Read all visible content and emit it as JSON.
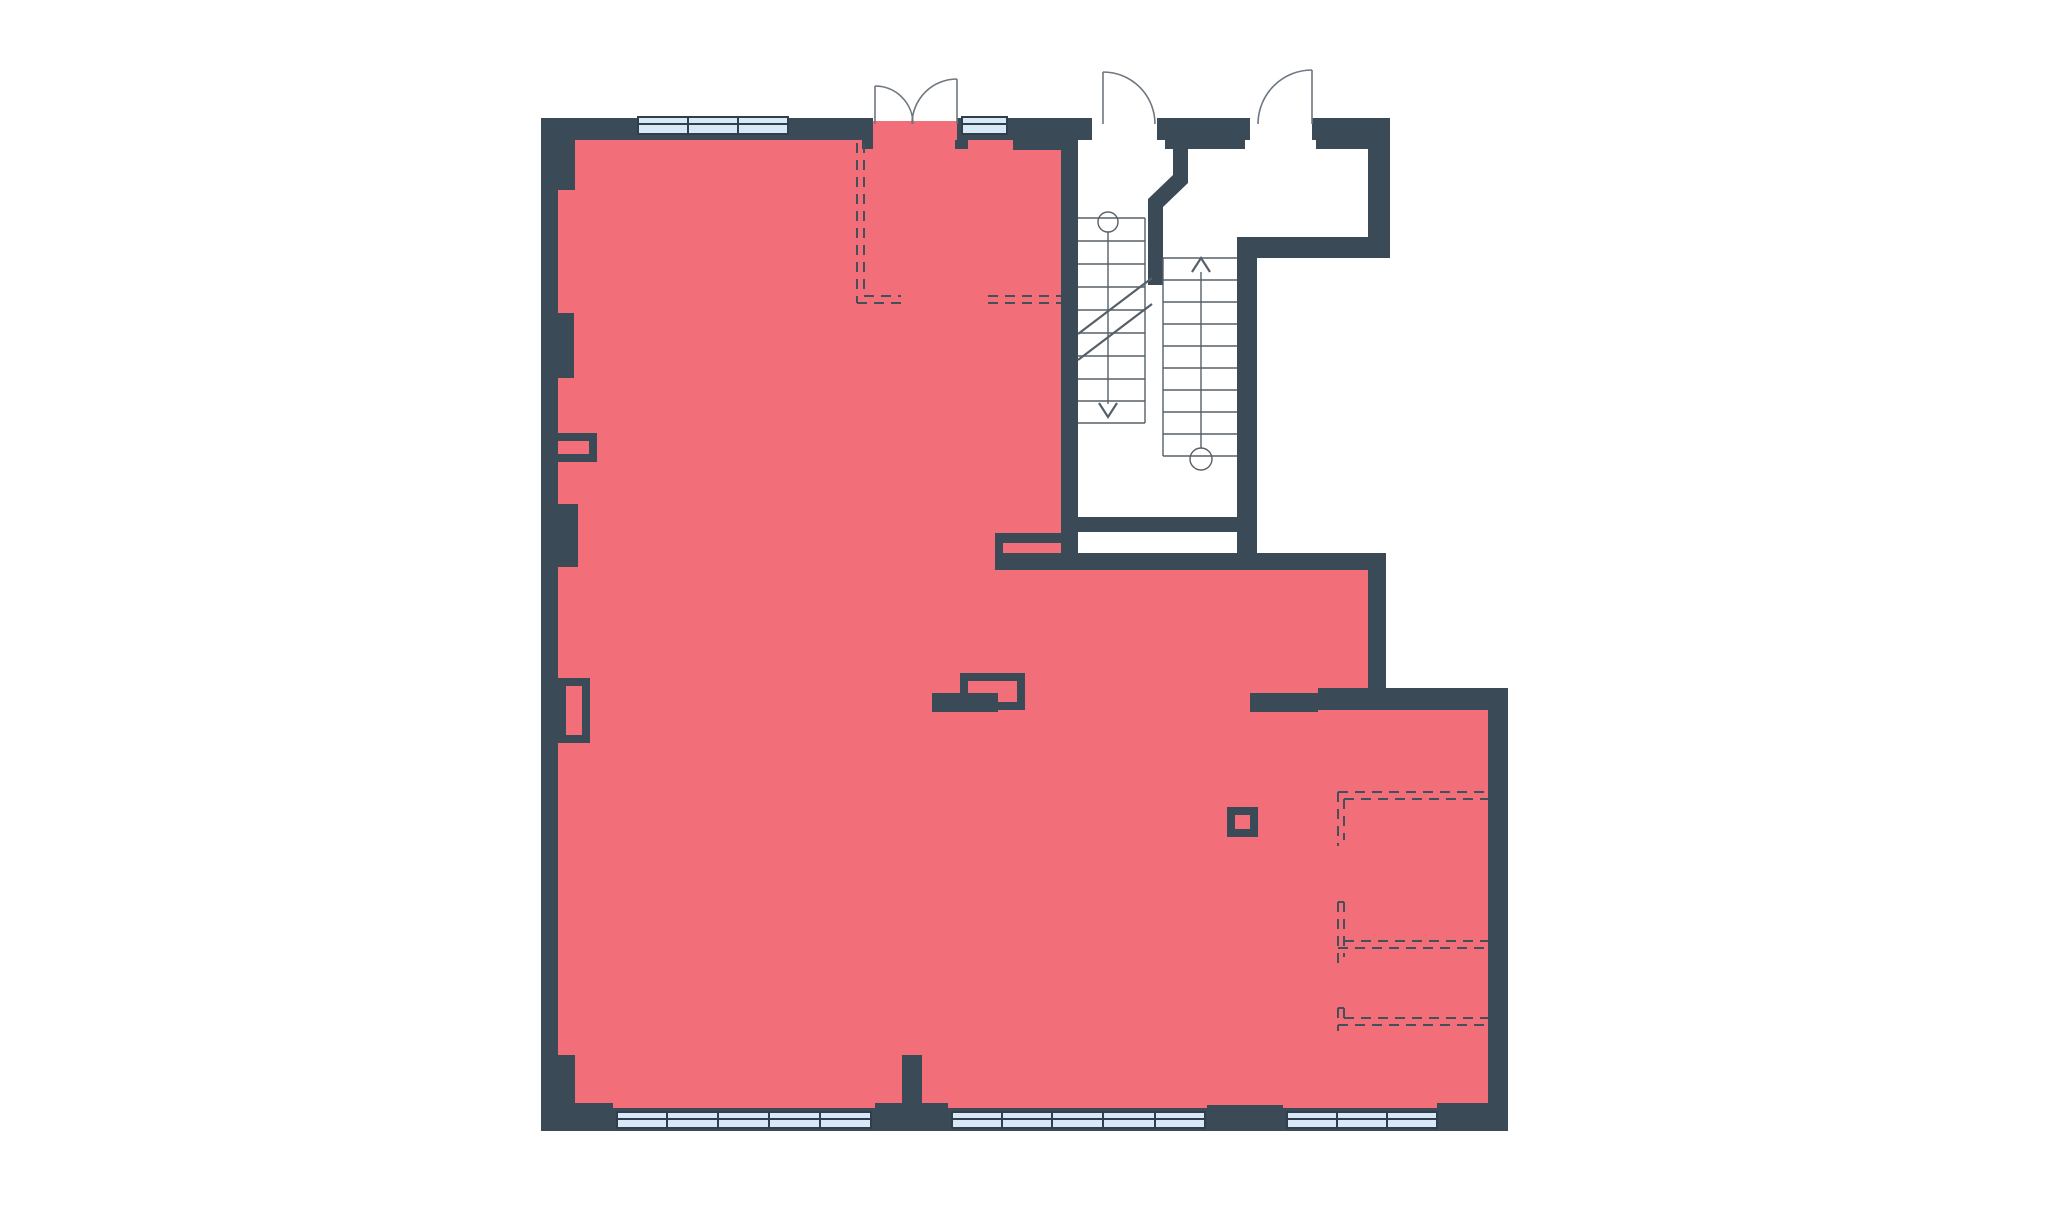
{
  "meta": {
    "type": "architectural-floor-plan",
    "view": "2d-top-down",
    "text_labels": []
  },
  "colors": {
    "background": "#ffffff",
    "wall": "#3a4a56",
    "unit": "#f26f7a",
    "glass": "#d9e8f7",
    "frame": "#2f3f4c",
    "stairline": "#566069",
    "doorarc": "#6e7780",
    "dashline": "#454f5a"
  },
  "plan": {
    "highlighted_unit": {
      "fill": "#f26f7a",
      "areas": [
        "main-hall-left",
        "upper-middle-room",
        "lower-right-extension"
      ]
    },
    "stairwell": {
      "flights": 2,
      "left_flight_treads": 10,
      "right_flight_treads": 10,
      "arrows": [
        "down-left-flight",
        "up-right-flight"
      ],
      "start_end_symbols": [
        "circle-top-left-flight",
        "circle-bottom-right-flight"
      ]
    },
    "doors": [
      {
        "id": "double-entrance-door",
        "type": "double-swing",
        "location": "top-wall-into-unit"
      },
      {
        "id": "stairwell-entrance-door",
        "type": "single-swing",
        "location": "top-wall-into-stair-vestibule"
      },
      {
        "id": "side-room-door",
        "type": "single-swing",
        "location": "top-wall-into-right-room"
      }
    ],
    "windows": {
      "top_wall": [
        {
          "id": "top-window-1",
          "panes": 3
        },
        {
          "id": "top-window-2",
          "panes": 1
        }
      ],
      "bottom_wall": [
        {
          "id": "bottom-window-1",
          "panes": 5
        },
        {
          "id": "bottom-window-2",
          "panes": 5
        },
        {
          "id": "bottom-window-3",
          "panes": 3
        }
      ]
    },
    "dashed_features": [
      {
        "id": "upper-dashed-partition",
        "shape": "L"
      },
      {
        "id": "right-wall-dashed-fixture-1"
      },
      {
        "id": "right-wall-dashed-fixture-2"
      },
      {
        "id": "right-wall-dashed-fixture-3"
      }
    ],
    "fixtures": {
      "left_wall_piers": 3,
      "left_wall_niches": 2,
      "counter-island": 1,
      "small-shaft-square": 1,
      "bottom_wall_piers": 2
    }
  }
}
